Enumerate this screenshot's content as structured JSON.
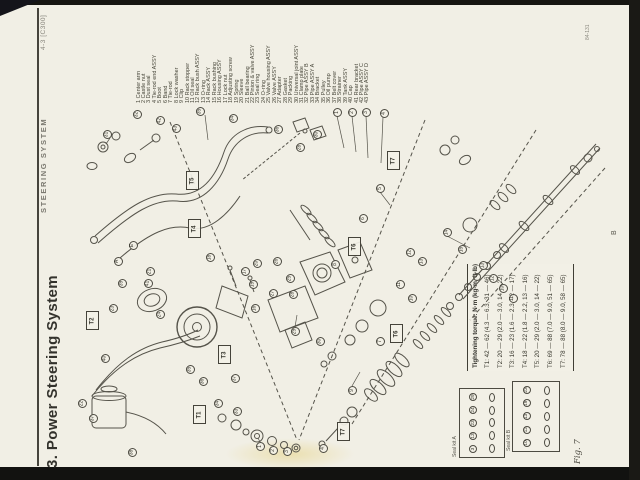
{
  "page": {
    "section_code": "4-3 [C300]",
    "chapter_title": "STEERING SYSTEM",
    "section_title": "3. Power Steering System",
    "page_code": "84-131",
    "edge_marker": "B",
    "fig_label": "Fig. 7",
    "paper_color": "#f1efe5",
    "ink_color": "#3d3c35"
  },
  "parts_list": [
    {
      "num": 1,
      "name": "Center arm"
    },
    {
      "num": 2,
      "name": "Castle nut"
    },
    {
      "num": 3,
      "name": "Dust seal"
    },
    {
      "num": 4,
      "name": "Tie-rod end ASSY"
    },
    {
      "num": 5,
      "name": "Boot"
    },
    {
      "num": 6,
      "name": "Band"
    },
    {
      "num": 7,
      "name": "Tie-rod"
    },
    {
      "num": 8,
      "name": "Lock washer"
    },
    {
      "num": 9,
      "name": "Clip"
    },
    {
      "num": 10,
      "name": "Rack stopper"
    },
    {
      "num": 11,
      "name": "Oil seal"
    },
    {
      "num": 12,
      "name": "Rack bush ASSY"
    },
    {
      "num": 13,
      "name": "O-ring"
    },
    {
      "num": 14,
      "name": "Rack ASSY"
    },
    {
      "num": 15,
      "name": "Rack bushing"
    },
    {
      "num": 16,
      "name": "Housing ASSY"
    },
    {
      "num": 17,
      "name": "Lock nut"
    },
    {
      "num": 18,
      "name": "Adjusting screw"
    },
    {
      "num": 19,
      "name": "Spring"
    },
    {
      "num": 20,
      "name": "Sleeve"
    },
    {
      "num": 21,
      "name": "Ball bearing"
    },
    {
      "num": 22,
      "name": "Pinion & valve ASSY"
    },
    {
      "num": 23,
      "name": "Seal ring"
    },
    {
      "num": 24,
      "name": "O-ring"
    },
    {
      "num": 25,
      "name": "Valve housing ASSY"
    },
    {
      "num": 26,
      "name": "Valve ASSY"
    },
    {
      "num": 27,
      "name": "Adapter"
    },
    {
      "num": 28,
      "name": "Gasket"
    },
    {
      "num": 29,
      "name": "Packing"
    },
    {
      "num": 30,
      "name": "Universal joint ASSY"
    },
    {
      "num": 31,
      "name": "Clamp plate"
    },
    {
      "num": 32,
      "name": "Pipe ASSY B"
    },
    {
      "num": 33,
      "name": "Pipe ASSY A"
    },
    {
      "num": 34,
      "name": "Bracket"
    },
    {
      "num": 35,
      "name": "Pulley"
    },
    {
      "num": 36,
      "name": "Oil pump"
    },
    {
      "num": 37,
      "name": "Belt cover"
    },
    {
      "num": 38,
      "name": "Strainer"
    },
    {
      "num": 39,
      "name": "Tank ASSY"
    },
    {
      "num": 40,
      "name": "Cap"
    },
    {
      "num": 41,
      "name": "Rear bracket"
    },
    {
      "num": 42,
      "name": "Pipe ASSY C"
    },
    {
      "num": 43,
      "name": "Pipe ASSY D"
    }
  ],
  "torque_table": {
    "title": "Tightening torque: N·m (kg-m, ft-lb)",
    "rows": [
      "T1: 42 — 62 (4.3 — 6.3, 31 — 46)",
      "T2: 20 — 29 (2.0 — 3.0, 14 — 22)",
      "T3: 16 — 23 (1.6 — 2.3, 12 — 17)",
      "T4: 18 — 22 (1.8 — 2.2, 13 — 16)",
      "T5: 20 — 29 (2.0 — 3.0, 14 — 22)",
      "T6: 69 — 88 (7.0 — 9.0, 51 — 65)",
      "T7: 78 — 88 (8.0 — 9.0, 58 — 65)"
    ]
  },
  "seal_kits": [
    {
      "label": "Seal kit A",
      "items": [
        "3",
        "13",
        "23",
        "24",
        "29"
      ]
    },
    {
      "label": "Seal kit B",
      "items": [
        "10",
        "12",
        "13",
        "19",
        "23"
      ]
    }
  ],
  "torque_boxes": [
    {
      "label": "T5",
      "x": 186,
      "y": 171
    },
    {
      "label": "T4",
      "x": 188,
      "y": 219
    },
    {
      "label": "T7",
      "x": 387,
      "y": 151
    },
    {
      "label": "T6",
      "x": 348,
      "y": 237
    },
    {
      "label": "T6",
      "x": 390,
      "y": 324
    },
    {
      "label": "T2",
      "x": 86,
      "y": 311
    },
    {
      "label": "T3",
      "x": 218,
      "y": 345
    },
    {
      "label": "T1",
      "x": 193,
      "y": 405
    },
    {
      "label": "T7",
      "x": 337,
      "y": 422
    }
  ],
  "callouts": [
    {
      "n": 31,
      "x": 107,
      "y": 134
    },
    {
      "n": 32,
      "x": 137,
      "y": 114
    },
    {
      "n": 35,
      "x": 200,
      "y": 111
    },
    {
      "n": 34,
      "x": 233,
      "y": 118
    },
    {
      "n": 36,
      "x": 278,
      "y": 129
    },
    {
      "n": 30,
      "x": 317,
      "y": 134
    },
    {
      "n": 28,
      "x": 300,
      "y": 147
    },
    {
      "n": 1,
      "x": 337,
      "y": 112
    },
    {
      "n": 2,
      "x": 352,
      "y": 112
    },
    {
      "n": 3,
      "x": 366,
      "y": 112
    },
    {
      "n": 4,
      "x": 384,
      "y": 113
    },
    {
      "n": 42,
      "x": 160,
      "y": 120
    },
    {
      "n": 43,
      "x": 176,
      "y": 128
    },
    {
      "n": 5,
      "x": 380,
      "y": 188
    },
    {
      "n": 6,
      "x": 363,
      "y": 218
    },
    {
      "n": 8,
      "x": 335,
      "y": 264
    },
    {
      "n": 7,
      "x": 380,
      "y": 341
    },
    {
      "n": 14,
      "x": 447,
      "y": 232
    },
    {
      "n": 15,
      "x": 462,
      "y": 249
    },
    {
      "n": 13,
      "x": 483,
      "y": 265
    },
    {
      "n": 12,
      "x": 493,
      "y": 278
    },
    {
      "n": 10,
      "x": 503,
      "y": 288
    },
    {
      "n": 11,
      "x": 513,
      "y": 298
    },
    {
      "n": 13,
      "x": 422,
      "y": 261
    },
    {
      "n": 12,
      "x": 410,
      "y": 252
    },
    {
      "n": 11,
      "x": 400,
      "y": 284
    },
    {
      "n": 10,
      "x": 412,
      "y": 298
    },
    {
      "n": 9,
      "x": 352,
      "y": 390
    },
    {
      "n": 16,
      "x": 255,
      "y": 308
    },
    {
      "n": 17,
      "x": 245,
      "y": 271
    },
    {
      "n": 18,
      "x": 210,
      "y": 257
    },
    {
      "n": 19,
      "x": 253,
      "y": 284
    },
    {
      "n": 20,
      "x": 257,
      "y": 263
    },
    {
      "n": 21,
      "x": 150,
      "y": 271
    },
    {
      "n": 23,
      "x": 113,
      "y": 308
    },
    {
      "n": 24,
      "x": 160,
      "y": 314
    },
    {
      "n": 41,
      "x": 148,
      "y": 283
    },
    {
      "n": 39,
      "x": 122,
      "y": 283
    },
    {
      "n": 25,
      "x": 290,
      "y": 278
    },
    {
      "n": 26,
      "x": 277,
      "y": 261
    },
    {
      "n": 27,
      "x": 273,
      "y": 293
    },
    {
      "n": 28,
      "x": 293,
      "y": 294
    },
    {
      "n": 29,
      "x": 295,
      "y": 331
    },
    {
      "n": 30,
      "x": 320,
      "y": 341
    },
    {
      "n": 33,
      "x": 237,
      "y": 411
    },
    {
      "n": 34,
      "x": 218,
      "y": 403
    },
    {
      "n": 35,
      "x": 190,
      "y": 369
    },
    {
      "n": 36,
      "x": 203,
      "y": 381
    },
    {
      "n": 37,
      "x": 235,
      "y": 378
    },
    {
      "n": 22,
      "x": 82,
      "y": 403
    },
    {
      "n": 37,
      "x": 93,
      "y": 418
    },
    {
      "n": 38,
      "x": 132,
      "y": 452
    },
    {
      "n": 40,
      "x": 105,
      "y": 358
    },
    {
      "n": 1,
      "x": 260,
      "y": 446
    },
    {
      "n": 2,
      "x": 273,
      "y": 450
    },
    {
      "n": 3,
      "x": 287,
      "y": 451
    },
    {
      "n": 4,
      "x": 323,
      "y": 448
    }
  ],
  "letter_callouts": [
    {
      "n": "A",
      "x": 118,
      "y": 261
    },
    {
      "n": "E",
      "x": 133,
      "y": 245
    }
  ]
}
